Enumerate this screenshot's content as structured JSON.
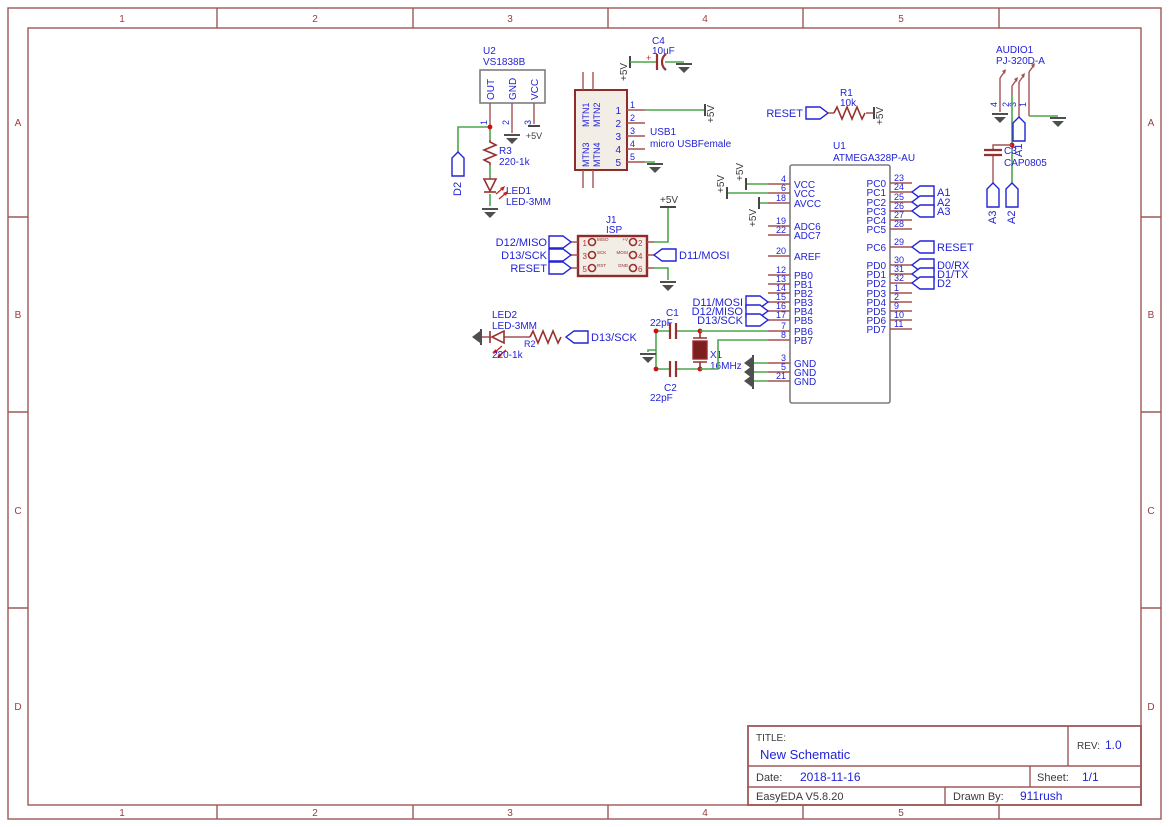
{
  "frame": {
    "cols": [
      "1",
      "2",
      "3",
      "4",
      "5"
    ],
    "rows": [
      "A",
      "B",
      "C",
      "D"
    ]
  },
  "title_block": {
    "title_label": "TITLE:",
    "title": "New Schematic",
    "rev_label": "REV:",
    "rev": "1.0",
    "date_label": "Date:",
    "date": "2018-11-16",
    "sheet_label": "Sheet:",
    "sheet": "1/1",
    "software": "EasyEDA V5.8.20",
    "drawn_by_label": "Drawn By:",
    "drawn_by": "911rush"
  },
  "power": {
    "p5v": "+5V"
  },
  "net_labels": {
    "d2": "D2",
    "reset": "RESET",
    "d13": "D13/SCK",
    "d11": "D11/MOSI"
  },
  "u2": {
    "ref": "U2",
    "value": "VS1838B",
    "pin_names": [
      "OUT",
      "GND",
      "VCC"
    ],
    "pin_nums": [
      "1",
      "2",
      "3"
    ]
  },
  "r3": {
    "ref": "R3",
    "value": "220-1k"
  },
  "led1": {
    "ref": "LED1",
    "value": "LED-3MM"
  },
  "led2": {
    "ref": "LED2",
    "value": "LED-3MM"
  },
  "r2": {
    "ref": "R2",
    "value": "220-1k"
  },
  "r1": {
    "ref": "R1",
    "value": "10k"
  },
  "c4": {
    "ref": "C4",
    "value": "10uF",
    "plus": "+"
  },
  "usb1": {
    "ref": "USB1",
    "value": "micro USBFemale",
    "mtn": [
      "MTN1",
      "MTN2",
      "MTN3",
      "MTN4"
    ],
    "pins": [
      "1",
      "2",
      "3",
      "4",
      "5"
    ]
  },
  "j1": {
    "ref": "J1",
    "value": "ISP",
    "left_nums": [
      "1",
      "3",
      "5"
    ],
    "right_nums": [
      "2",
      "4",
      "6"
    ],
    "left_names": [
      "MISO",
      "SCK",
      "RST"
    ],
    "right_names": [
      "+V",
      "MOSI",
      "GND"
    ],
    "left_labels": [
      "D12/MISO",
      "D13/SCK",
      "RESET"
    ]
  },
  "xtal": {
    "c1_ref": "C1",
    "c1_value": "22pF",
    "c2_ref": "C2",
    "c2_value": "22pF",
    "x1_ref": "X1",
    "x1_value": "16MHz"
  },
  "audio1": {
    "ref": "AUDIO1",
    "value": "PJ-320D-A",
    "pins": [
      "4",
      "2",
      "3",
      "1"
    ],
    "a1": "A1",
    "a2": "A2",
    "a3": "A3"
  },
  "c3": {
    "ref": "C3",
    "value": "CAP0805"
  },
  "u1": {
    "ref": "U1",
    "value": "ATMEGA328P-AU",
    "left": [
      {
        "n": "4",
        "name": "VCC"
      },
      {
        "n": "6",
        "name": "VCC"
      },
      {
        "n": "18",
        "name": "AVCC"
      },
      {
        "n": "19",
        "name": "ADC6"
      },
      {
        "n": "22",
        "name": "ADC7"
      },
      {
        "n": "20",
        "name": "AREF"
      },
      {
        "n": "12",
        "name": "PB0"
      },
      {
        "n": "13",
        "name": "PB1"
      },
      {
        "n": "14",
        "name": "PB2"
      },
      {
        "n": "15",
        "name": "PB3"
      },
      {
        "n": "16",
        "name": "PB4"
      },
      {
        "n": "17",
        "name": "PB5"
      },
      {
        "n": "7",
        "name": "PB6"
      },
      {
        "n": "8",
        "name": "PB7"
      },
      {
        "n": "3",
        "name": "GND"
      },
      {
        "n": "5",
        "name": "GND"
      },
      {
        "n": "21",
        "name": "GND"
      }
    ],
    "right": [
      {
        "n": "23",
        "name": "PC0"
      },
      {
        "n": "24",
        "name": "PC1"
      },
      {
        "n": "25",
        "name": "PC2"
      },
      {
        "n": "26",
        "name": "PC3"
      },
      {
        "n": "27",
        "name": "PC4"
      },
      {
        "n": "28",
        "name": "PC5"
      },
      {
        "n": "29",
        "name": "PC6"
      },
      {
        "n": "30",
        "name": "PD0"
      },
      {
        "n": "31",
        "name": "PD1"
      },
      {
        "n": "32",
        "name": "PD2"
      },
      {
        "n": "1",
        "name": "PD3"
      },
      {
        "n": "2",
        "name": "PD4"
      },
      {
        "n": "9",
        "name": "PD5"
      },
      {
        "n": "10",
        "name": "PD6"
      },
      {
        "n": "11",
        "name": "PD7"
      }
    ],
    "left_flags": [
      "D11/MOSI",
      "D12/MISO",
      "D13/SCK"
    ],
    "right_flags": [
      "A1",
      "A2",
      "A3",
      "RESET",
      "D0/RX",
      "D1/TX",
      "D2"
    ]
  }
}
